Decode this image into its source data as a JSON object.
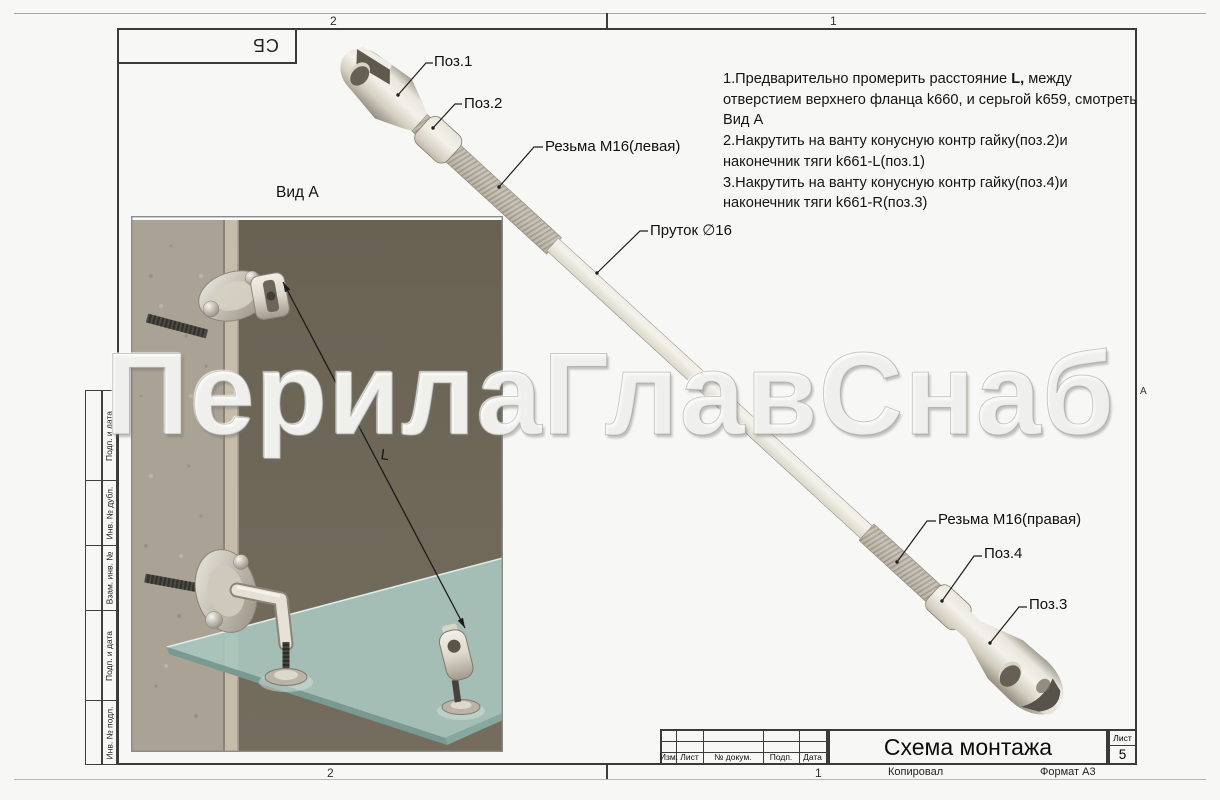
{
  "frame": {
    "zone_top_left": "2",
    "zone_top_right": "1",
    "zone_bottom_left": "2",
    "zone_bottom_right": "1",
    "zone_letter_right": "А",
    "designation_stamp": "СБ"
  },
  "side_strip": {
    "labels": [
      "Подп. и дата",
      "Инв. № дубл.",
      "Взам. инв. №",
      "Подп. и дата",
      "Инв. № подл."
    ]
  },
  "watermark": {
    "text": "ПерилаГлавСнаб"
  },
  "view_label": "Вид А",
  "dimension_label": "L",
  "callouts": {
    "pos1": "Поз.1",
    "pos2": "Поз.2",
    "thread_left": "Резьма М16(левая)",
    "rod": "Пруток ∅16",
    "thread_right": "Резьма М16(правая)",
    "pos4": "Поз.4",
    "pos3": "Поз.3"
  },
  "instructions": {
    "item1_pre": "1.Предварительно промерить расстояние ",
    "item1_bold": "L,",
    "item1_post": " между отверстием верхнего фланца k660, и серьгой k659, смотреть Вид А",
    "item2": "2.Накрутить на ванту конусную контр гайку(поз.2)и наконечник тяги k661-L(поз.1)",
    "item3": "3.Накрутить на ванту конусную контр гайку(поз.4)и наконечник тяги k661-R(поз.3)"
  },
  "title_block": {
    "headers": [
      "Изм.",
      "Лист",
      "№ докум.",
      "Подп.",
      "Дата"
    ],
    "title": "Схема монтажа",
    "sheet_label": "Лист",
    "sheet_number": "5",
    "copied_label": "Копировал",
    "format_label": "Формат А3"
  },
  "colors": {
    "paper": "#f7f7f5",
    "frame": "#3a3a3a",
    "wall": "#6e675b",
    "concrete": "#a9a295",
    "glass": "#a9c6bd",
    "metal-light": "#f3f1ea",
    "metal-dark": "#8f887a"
  }
}
